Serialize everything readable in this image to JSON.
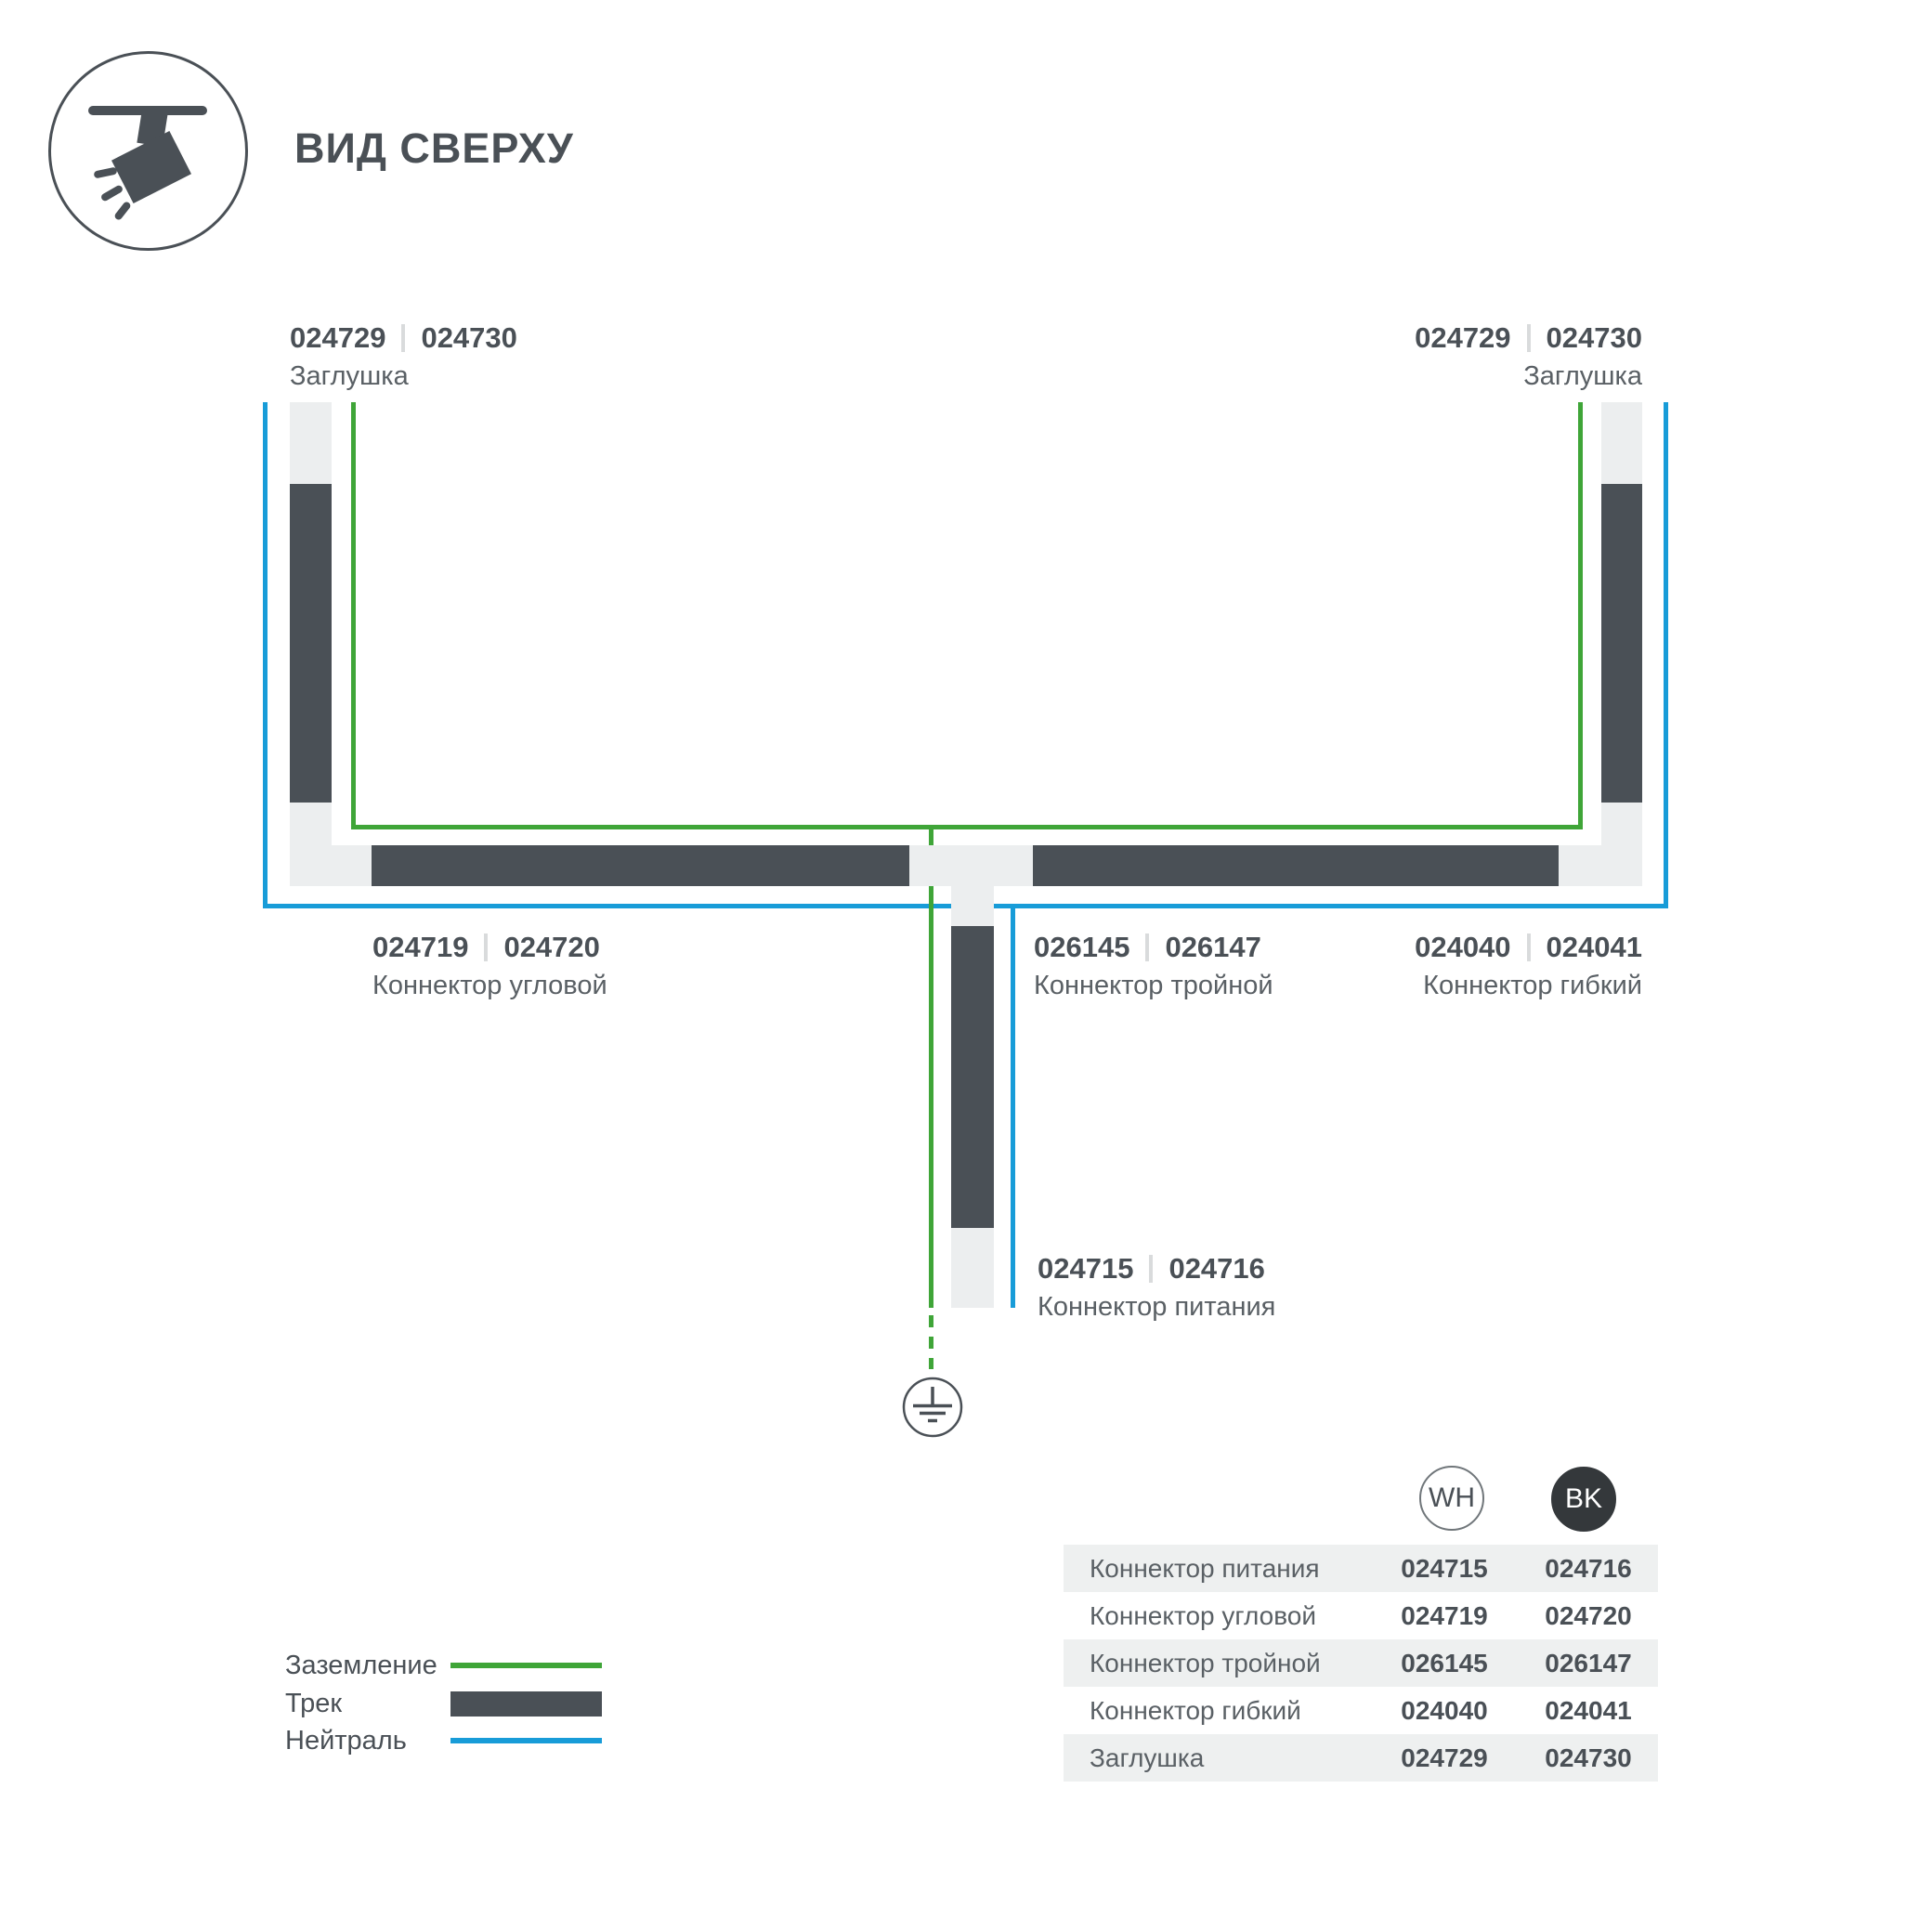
{
  "colors": {
    "track": "#4A5056",
    "connector_light": "#ECEEEF",
    "ground_green": "#3FA538",
    "neutral_blue": "#189CD8",
    "text_dark": "#4A5056",
    "text_medium": "#5A6065",
    "table_stripe": "#EEF0F0",
    "bk_circle": "#34383B"
  },
  "icons": {
    "app": "track-light-icon",
    "ground": "earth-ground-icon"
  },
  "header": {
    "title": "ВИД СВЕРХУ"
  },
  "diagram": {
    "labels": {
      "cap_left": {
        "code_wh": "024729",
        "code_bk": "024730",
        "name": "Заглушка"
      },
      "cap_right": {
        "code_wh": "024729",
        "code_bk": "024730",
        "name": "Заглушка"
      },
      "corner": {
        "code_wh": "024719",
        "code_bk": "024720",
        "name": "Коннектор угловой"
      },
      "triple": {
        "code_wh": "026145",
        "code_bk": "026147",
        "name": "Коннектор тройной"
      },
      "flexible": {
        "code_wh": "024040",
        "code_bk": "024041",
        "name": "Коннектор гибкий"
      },
      "power": {
        "code_wh": "024715",
        "code_bk": "024716",
        "name": "Коннектор питания"
      }
    }
  },
  "legend": {
    "items": [
      {
        "label": "Заземление",
        "swatch": "ground-line"
      },
      {
        "label": "Трек",
        "swatch": "track-bar"
      },
      {
        "label": "Нейтраль",
        "swatch": "neutral-line"
      }
    ]
  },
  "table": {
    "columns": [
      {
        "id": "wh",
        "label": "WH"
      },
      {
        "id": "bk",
        "label": "BK"
      }
    ],
    "rows": [
      {
        "name": "Коннектор питания",
        "wh": "024715",
        "bk": "024716"
      },
      {
        "name": "Коннектор угловой",
        "wh": "024719",
        "bk": "024720"
      },
      {
        "name": "Коннектор тройной",
        "wh": "026145",
        "bk": "026147"
      },
      {
        "name": "Коннектор гибкий",
        "wh": "024040",
        "bk": "024041"
      },
      {
        "name": "Заглушка",
        "wh": "024729",
        "bk": "024730"
      }
    ]
  }
}
